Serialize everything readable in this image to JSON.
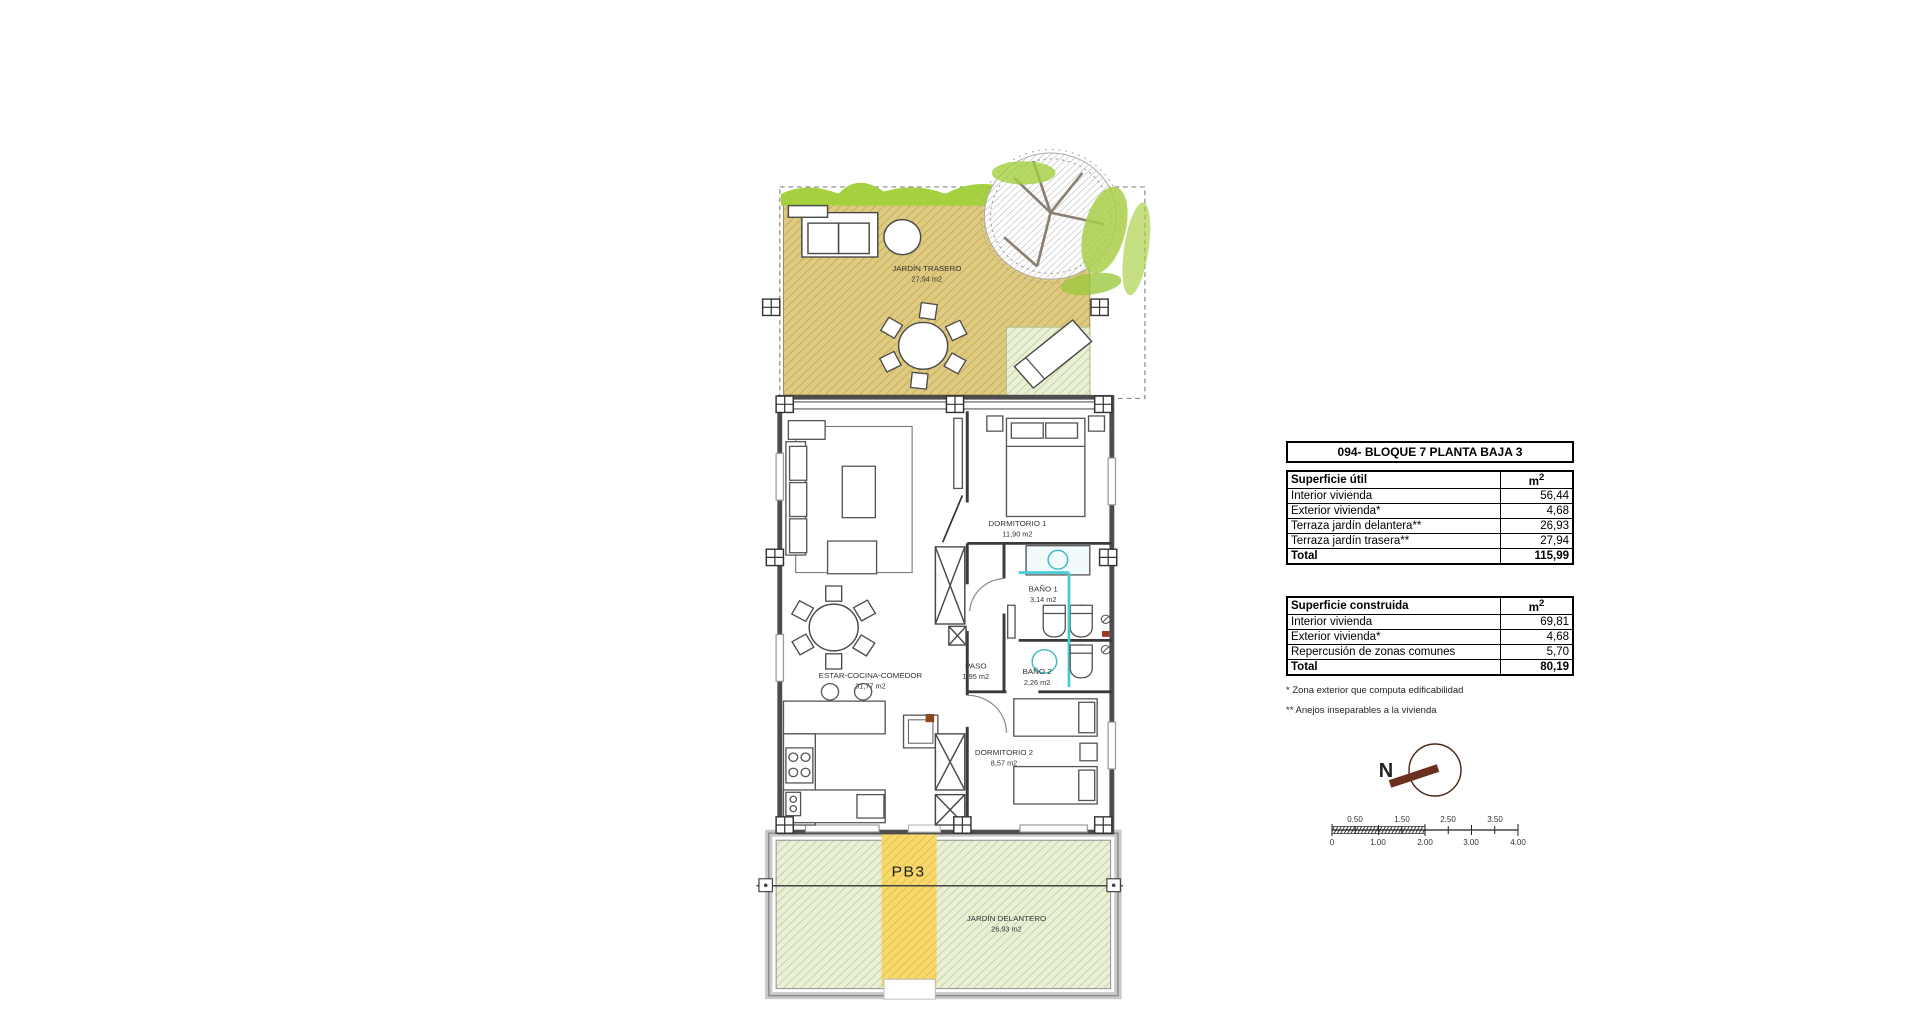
{
  "title": "094- BLOQUE 7 PLANTA BAJA 3",
  "tables": [
    {
      "header": "Superficie útil",
      "unit": "m",
      "unit_sup": "2",
      "rows": [
        {
          "label": "Interior vivienda",
          "value": "56,44"
        },
        {
          "label": "Exterior vivienda*",
          "value": "4,68"
        },
        {
          "label": "Terraza jardín delantera**",
          "value": "26,93"
        },
        {
          "label": "Terraza jardín trasera**",
          "value": "27,94"
        }
      ],
      "total_label": "Total",
      "total_value": "115,99"
    },
    {
      "header": "Superficie construida",
      "unit": "m",
      "unit_sup": "2",
      "rows": [
        {
          "label": "Interior vivienda",
          "value": "69,81"
        },
        {
          "label": "Exterior vivienda*",
          "value": "4,68"
        },
        {
          "label": "Repercusión de zonas comunes",
          "value": "5,70"
        }
      ],
      "total_label": "Total",
      "total_value": "80,19"
    }
  ],
  "footnotes": [
    "* Zona exterior que computa edificabilidad",
    "** Anejos inseparables a la vivienda"
  ],
  "plan": {
    "unit_label": "PB3",
    "rooms": {
      "jardin_trasero": {
        "name": "JARDÍN TRASERO",
        "area": "27,94 m2"
      },
      "dormitorio1": {
        "name": "DORMITORIO 1",
        "area": "11,90 m2"
      },
      "bano1": {
        "name": "BAÑO 1",
        "area": "3,14 m2"
      },
      "paso": {
        "name": "PASO",
        "area": "1,95 m2"
      },
      "bano2": {
        "name": "BAÑO 2",
        "area": "2,26 m2"
      },
      "estar": {
        "name": "ESTAR-COCINA-COMEDOR",
        "area": "31,77 m2"
      },
      "dormitorio2": {
        "name": "DORMITORIO 2",
        "area": "8,57 m2"
      },
      "jardin_delantero": {
        "name": "JARDÍN DELANTERO",
        "area": "26,93 m2"
      }
    },
    "colors": {
      "terrace_tan": "#decb81",
      "grass_green": "#a5d03f",
      "garden_light_green": "#eaf0d8",
      "path_yellow": "#f7d96d",
      "glass_cyan": "#45c8d8",
      "compass_brown": "#6b2f1f"
    }
  },
  "compass": {
    "north_label": "N"
  },
  "scale_bar": {
    "top_labels": [
      "0.50",
      "1.50",
      "2.50",
      "3.50"
    ],
    "bottom_labels": [
      "0",
      "1.00",
      "2.00",
      "3.00",
      "4.00"
    ]
  }
}
